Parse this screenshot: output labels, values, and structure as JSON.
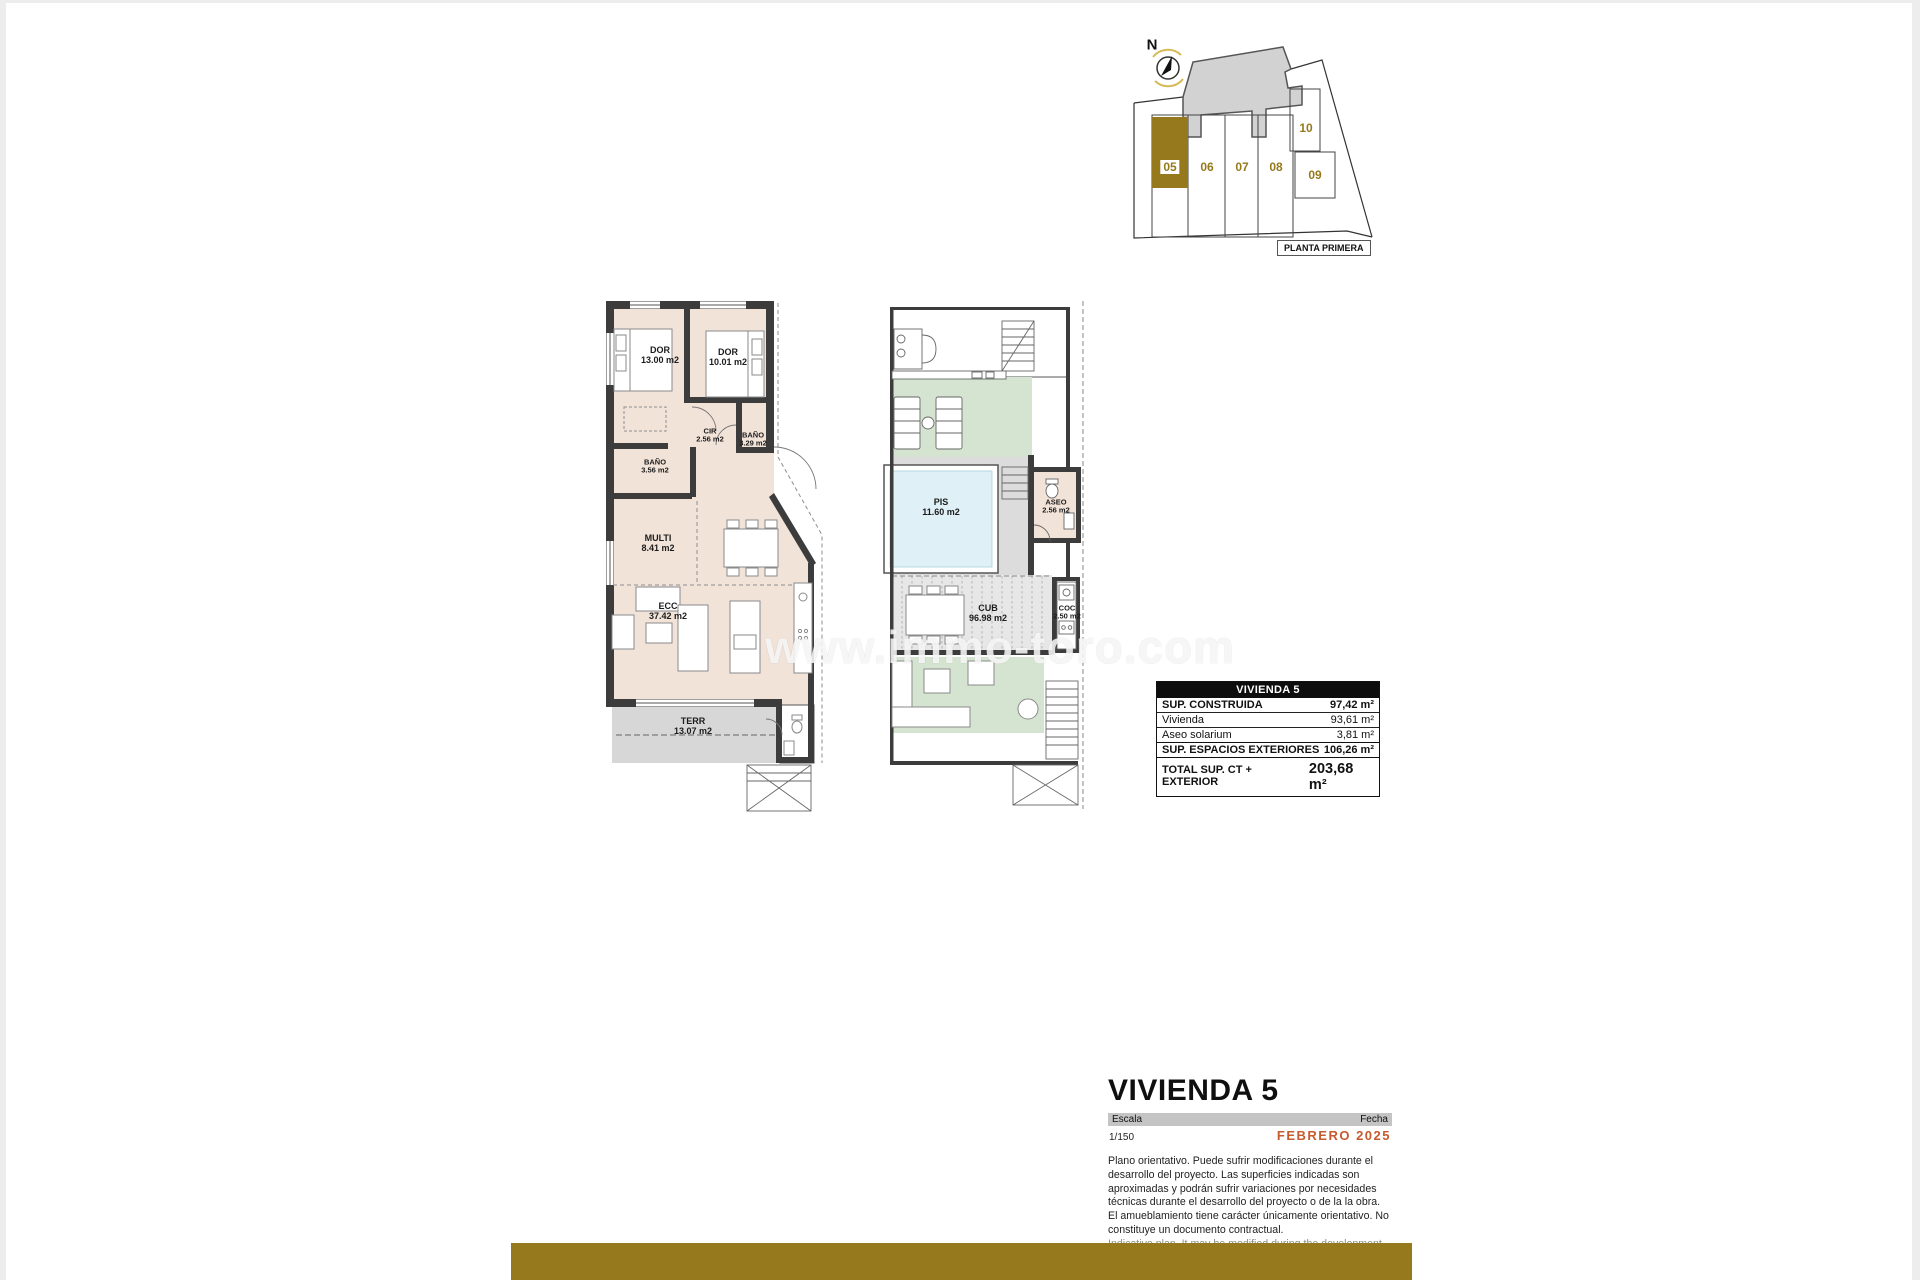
{
  "site_plan": {
    "compass_label": "N",
    "floor_label": "PLANTA PRIMERA",
    "highlight_color": "#96791d",
    "units": [
      {
        "id": "05",
        "highlighted": true
      },
      {
        "id": "06",
        "highlighted": false
      },
      {
        "id": "07",
        "highlighted": false
      },
      {
        "id": "08",
        "highlighted": false
      },
      {
        "id": "09",
        "highlighted": false
      },
      {
        "id": "10",
        "highlighted": false
      }
    ]
  },
  "floor_plans": {
    "interior": {
      "rooms": [
        {
          "name": "DOR",
          "area": "13.00 m2"
        },
        {
          "name": "DOR",
          "area": "10.01 m2"
        },
        {
          "name": "CIR",
          "area": "2.56 m2"
        },
        {
          "name": "BAÑO",
          "area": "3.29 m2"
        },
        {
          "name": "BAÑO",
          "area": "3.56 m2"
        },
        {
          "name": "MULTI",
          "area": "8.41 m2"
        },
        {
          "name": "ECC",
          "area": "37.42 m2"
        },
        {
          "name": "TERR",
          "area": "13.07 m2"
        }
      ]
    },
    "solarium": {
      "rooms": [
        {
          "name": "PIS",
          "area": "11.60 m2"
        },
        {
          "name": "ASEO",
          "area": "2.56 m2"
        },
        {
          "name": "CUB",
          "area": "96.98 m2"
        },
        {
          "name": "COC",
          "area": "2.50 m2"
        }
      ]
    }
  },
  "watermark": {
    "text": "www.immo-toro.com"
  },
  "summary_table": {
    "title": "VIVIENDA 5",
    "rows": [
      {
        "label": "SUP. CONSTRUIDA",
        "value": "97,42 m²"
      },
      {
        "label": "Vivienda",
        "value": "93,61 m²"
      },
      {
        "label": "Aseo solarium",
        "value": "3,81 m²"
      },
      {
        "label": "SUP. ESPACIOS EXTERIORES",
        "value": "106,26 m²"
      },
      {
        "label": "TOTAL SUP. CT + EXTERIOR",
        "value": "203,68 m²"
      }
    ]
  },
  "title_block": {
    "title": "VIVIENDA 5",
    "scale_label": "Escala",
    "scale_value": "1/150",
    "date_label": "Fecha",
    "date_value": "FEBRERO 2025",
    "date_color": "#c65b2e",
    "disclaimer_es": "Plano orientativo. Puede sufrir modificaciones durante el desarrollo del proyecto. Las superficies indicadas son aproximadas y podrán sufrir variaciones por necesidades técnicas durante el desarrollo del proyecto o de la la obra. El amueblamiento tiene carácter únicamente orientativo. No constituye un documento contractual.",
    "disclaimer_en": "Indicative plan. It may be modified during the development of the project. The areas indicated are approximate and may be subject to variations due to technical needs during the development of the project or the work. The furnishings are for guidance only. It does not constitute a contractual document."
  },
  "footer": {
    "bar_color": "#96791d"
  }
}
